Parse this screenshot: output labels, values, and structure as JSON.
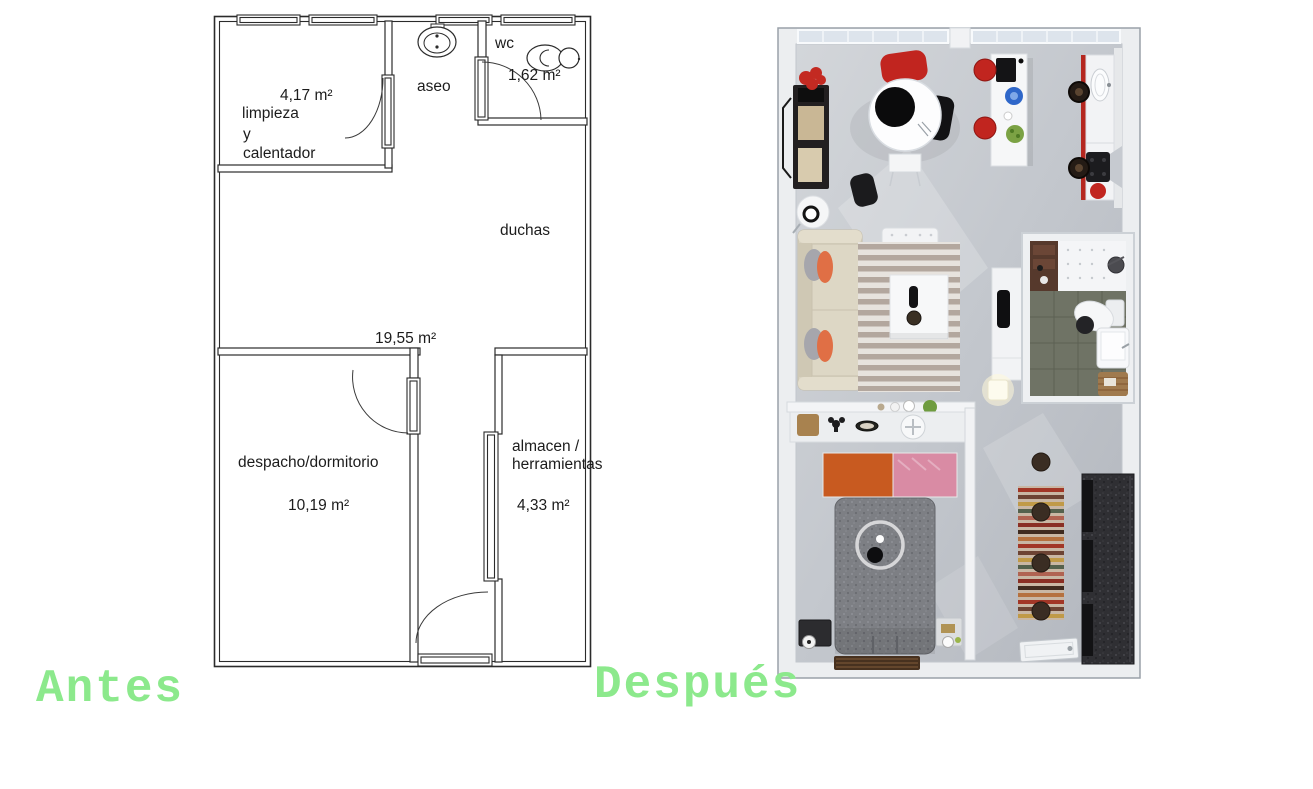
{
  "captions": {
    "before": "Antes",
    "after": "Después"
  },
  "floor_plan": {
    "rooms": {
      "limpieza": {
        "area": "4,17 m²",
        "name_line1": "limpieza",
        "name_line2": "y",
        "name_line3": "calentador"
      },
      "aseo": {
        "name": "aseo"
      },
      "wc": {
        "name": "wc",
        "area": "1,62 m²"
      },
      "duchas": {
        "name": "duchas",
        "area": "19,55 m²"
      },
      "despacho": {
        "name": "despacho/dormitorio",
        "area": "10,19 m²"
      },
      "almacen": {
        "name_line1": "almacen /",
        "name_line2": "herramientas",
        "area": "4,33 m²"
      }
    }
  },
  "colors": {
    "caption_green": "#8ce98c",
    "plan_line": "#2b2b2b",
    "render_accent_red": "#c1251f",
    "render_floor_gray": "#c3c7cd"
  }
}
